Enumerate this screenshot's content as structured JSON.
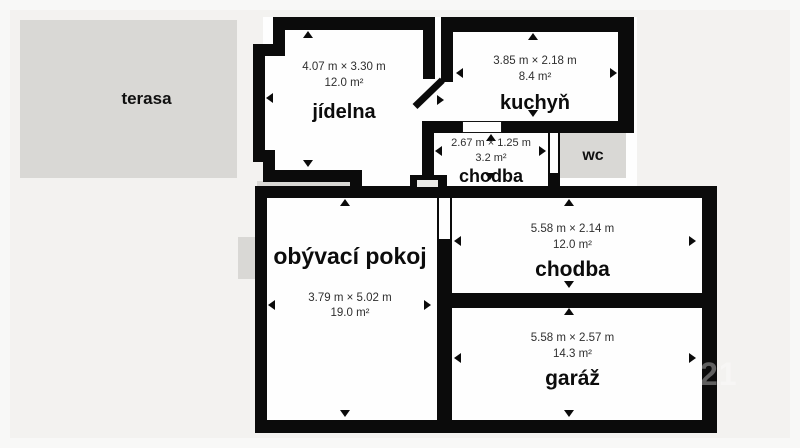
{
  "page": {
    "watermark": "21"
  },
  "outdoor": {
    "terrace_label": "terasa",
    "wc_label": "wc"
  },
  "rooms": [
    {
      "id": "jidelna",
      "name": "jídelna",
      "dimensions": "4.07 m × 3.30 m",
      "area": "12.0 m²"
    },
    {
      "id": "kuchyn",
      "name": "kuchyň",
      "dimensions": "3.85 m × 2.18 m",
      "area": "8.4 m²"
    },
    {
      "id": "chodba-mala",
      "name": "chodba",
      "dimensions": "2.67 m × 1.25 m",
      "area": "3.2 m²"
    },
    {
      "id": "obyvaci-pokoj",
      "name": "obývací pokoj",
      "dimensions": "3.79 m × 5.02 m",
      "area": "19.0 m²"
    },
    {
      "id": "chodba",
      "name": "chodba",
      "dimensions": "5.58 m × 2.14 m",
      "area": "12.0 m²"
    },
    {
      "id": "garaz",
      "name": "garáž",
      "dimensions": "5.58 m × 2.57 m",
      "area": "14.3 m²"
    }
  ],
  "colors": {
    "wall": "#0b0b0b",
    "room_fill": "#fefefe",
    "outdoor_fill": "#d9d8d5",
    "background": "#f3f2f0"
  }
}
